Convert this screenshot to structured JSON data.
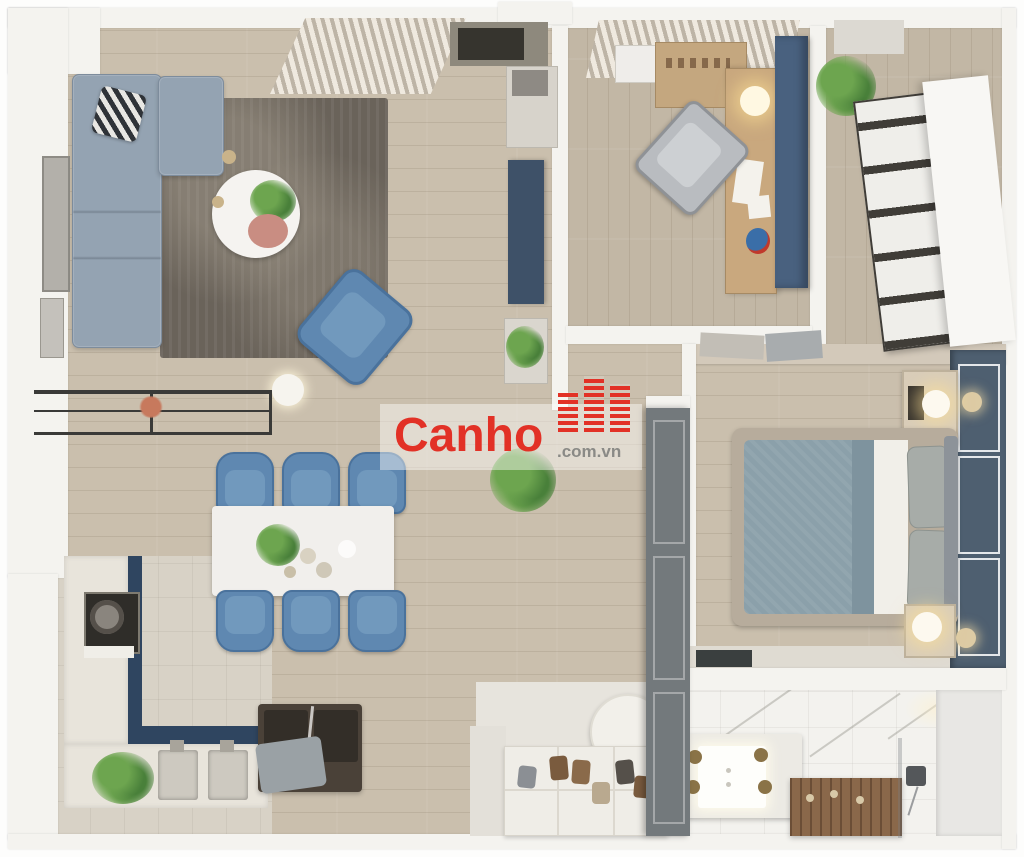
{
  "image_type": "3d-apartment-floor-plan-render",
  "watermark": {
    "brand": "Canho",
    "suffix": ".com.vn",
    "icon": "red-buildings-logo"
  },
  "rooms": [
    "living-dining-area",
    "kitchen",
    "study-room",
    "walk-in-closet",
    "master-bedroom",
    "bathroom",
    "entry-hall"
  ],
  "furniture": [
    "l-shaped-sofa",
    "zigzag-pillow",
    "area-rug",
    "round-coffee-table",
    "blue-armchair",
    "floor-lamp",
    "console-table",
    "tv-cabinet",
    "dining-table",
    "six-blue-dining-chairs",
    "kitchen-counter",
    "stove",
    "double-sink",
    "dark-island-bench",
    "desk",
    "desk-chair",
    "blue-tall-cabinet",
    "wardrobe-shelves",
    "double-bed",
    "two-nightstands",
    "bed-lamps",
    "vanity-sink",
    "teak-shower-mat",
    "shower-fixture",
    "shoe-cabinet",
    "round-pouf",
    "potted-plants"
  ],
  "colors": {
    "wood": "#cabfad",
    "woodStudy": "#c2b7a5",
    "tile": "#d8d2c6",
    "entryTile": "#e7e4dd",
    "wall": "#f4f3ef",
    "wallShade": "#e6e4dd",
    "rug": "#6a635a",
    "sofa": "#94a3b2",
    "sofaEdge": "#7d8c9c",
    "chairBlue": "#5f88b1",
    "chairBlueDark": "#4a729c",
    "chairSeat": "#7199bd",
    "navyUnit": "#3e5168",
    "navyCab": "#49617f",
    "counterNavy": "#2f4560",
    "accentWall": "#4e5f70",
    "duvet": "#8ba0aa",
    "sheet": "#f1efe9",
    "pillowGray": "#a7aca8",
    "bedFrame": "#b7ac9c",
    "tableWhite": "#f1efec",
    "marble": "#f3f2ee",
    "teak": "#8a684a",
    "bronze": "#8a7347",
    "green": "#6da54f",
    "greenDark": "#49803a",
    "red": "#e23126",
    "domainGray": "#8a8a86",
    "darkIsland": "#4a4138",
    "cushionDark": "#332e28",
    "cloth": "#9aa1a5",
    "doorPanel": "#73797c",
    "blindLight": "#efe9df",
    "blindDark": "#bdb4a6",
    "stove": "#2f2d29",
    "frameArt": "#b3b0aa"
  }
}
